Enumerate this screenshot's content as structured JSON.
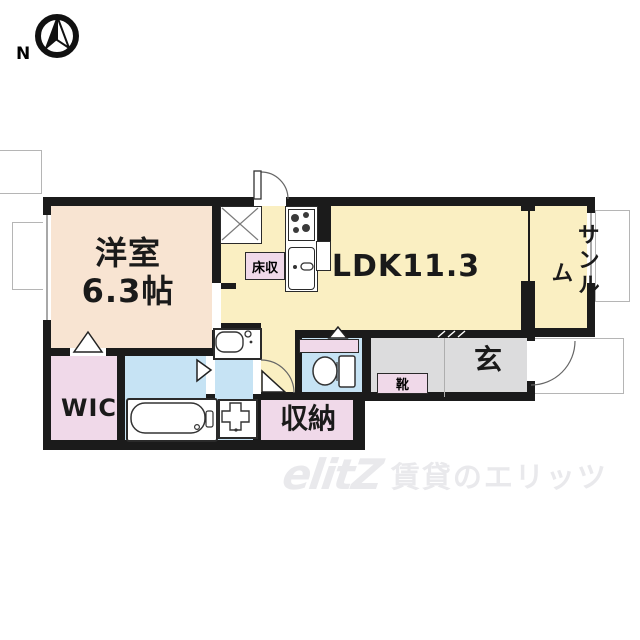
{
  "compass": {
    "north_label": "N"
  },
  "rooms": {
    "western_line1": "洋室",
    "western_line2": "6.3帖",
    "ldk": "LDK11.3",
    "sunroom": "サンルーム",
    "wic": "WIC",
    "storage": "収納",
    "entrance": "玄",
    "shoe_box": "靴",
    "floor_storage": "床収"
  },
  "watermark": {
    "logo": "elitZ",
    "text": "賃貸のエリッツ"
  },
  "colors": {
    "wall": "#1b1b1b",
    "western": "#f8e4d2",
    "ldk": "#faefc2",
    "closet": "#f0d9e9",
    "wet": "#c6e3f4",
    "entry": "#dcdcdd",
    "wm": "#e9e9ec"
  }
}
